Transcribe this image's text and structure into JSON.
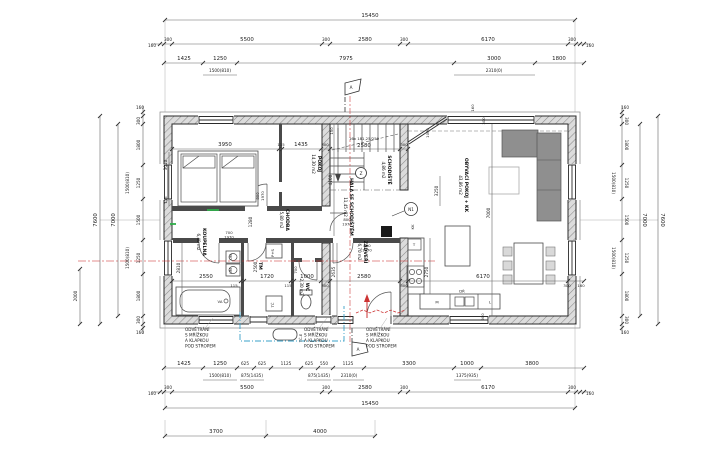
{
  "colors": {
    "line": "#2b2b2b",
    "wall_hatch": "#8a8a8a",
    "sofa": "#8f8f8f",
    "red": "#cc3333",
    "blue": "#3aa0c8",
    "green": "#2fae4a"
  },
  "top": {
    "overall": "15450",
    "ins_left": "160",
    "ins_right": "160",
    "segs": [
      "300",
      "5500",
      "300",
      "2580",
      "300",
      "6170",
      "300"
    ],
    "openings": [
      "1425",
      "1250",
      "7975",
      "3000",
      "1800"
    ],
    "windows": [
      "1500(810)",
      "2310(0)"
    ]
  },
  "bottom": {
    "openings": [
      "1425",
      "1250",
      "625",
      "625",
      "1125",
      "625",
      "550",
      "1125",
      "3300",
      "1000",
      "3800"
    ],
    "windows": [
      "1500(810)",
      "875(1435)",
      "875(1435)",
      "2310(0)",
      "1375(935)"
    ],
    "segs": [
      "300",
      "5500",
      "300",
      "2580",
      "300",
      "6170",
      "300"
    ],
    "ins_left": "160",
    "ins_right": "160",
    "overall": "15450",
    "foot": [
      "3700",
      "4000"
    ]
  },
  "left": {
    "overall": "7600",
    "inner": "7000",
    "partial": "2000",
    "ins_top": "160",
    "ins_bottom": "160",
    "segs": [
      "300",
      "1800",
      "1250",
      "1500",
      "1250",
      "1800",
      "300"
    ],
    "windows": [
      "1500(810)",
      "1500(810)"
    ]
  },
  "right": {
    "overall": "7600",
    "inner": "7000",
    "ins_top": "160",
    "ins_bottom": "160",
    "segs": [
      "300",
      "1800",
      "1250",
      "1500",
      "1250",
      "1800",
      "300"
    ],
    "windows": [
      "1500(810)",
      "1500(810)"
    ]
  },
  "rooms": {
    "pokoj": {
      "name": "POKOJ",
      "area": "14,30 m2"
    },
    "schodiste": {
      "name": "SCHODIŠTĚ",
      "area": "4,86 m2"
    },
    "hala": {
      "name": "HALA SE SCHODIŠTĚM",
      "area": "11,45 m2"
    },
    "obyvaci": {
      "name": "OBÝVACÍ POKOJ + KK",
      "area": "43,86 m2"
    },
    "koupelna": {
      "name": "KOUPELNA",
      "area": "6,40 m2"
    },
    "chodba": {
      "name": "CHODBA",
      "area": "5,80 m2"
    },
    "zadveri": {
      "name": "ZÁDVEŘÍ",
      "area": "6,70 m2"
    },
    "wc": {
      "name": "WC",
      "area": "2,30 m2"
    },
    "tm": {
      "name": "TM"
    }
  },
  "inner": {
    "row_main": [
      "3950",
      "115",
      "1435",
      "300",
      "2580",
      "300"
    ],
    "row_south": [
      "2550",
      "115",
      "1720",
      "115",
      "1000",
      "300",
      "2580",
      "300",
      "6170",
      "300",
      "160"
    ],
    "stair_note": "16x 181,25/250"
  },
  "vdims": {
    "pokoj_h": "3010",
    "p115": "115",
    "hala": "4100",
    "stair150": "150",
    "corner1000": "1000",
    "top160": "160",
    "top300": "300",
    "liv3250": "3250",
    "liv7000": "7000",
    "isl2750": "2750",
    "koup2810": "2810",
    "tech2500": "2500",
    "chod1280": "1280",
    "zadv2635": "2635"
  },
  "doors": {
    "d800": "800",
    "d700": "700",
    "d900": "900",
    "h1970": "1970"
  },
  "fix": {
    "bath": "VA",
    "basin": "UM",
    "washer": "P+S",
    "heat": "TČ",
    "heat_e": "TČ-E",
    "oven": "T",
    "dishwasher": "M",
    "sink": "DŘ",
    "fridge": "L",
    "kitchen": "KK"
  },
  "mk": {
    "section": "A",
    "z": "Z",
    "n1": "N1"
  },
  "notes": {
    "vent": [
      "ODVĚTRÁNÍ",
      "S MŘÍŽKOU",
      "A KLAPKOU",
      "POD STROPEM"
    ]
  }
}
